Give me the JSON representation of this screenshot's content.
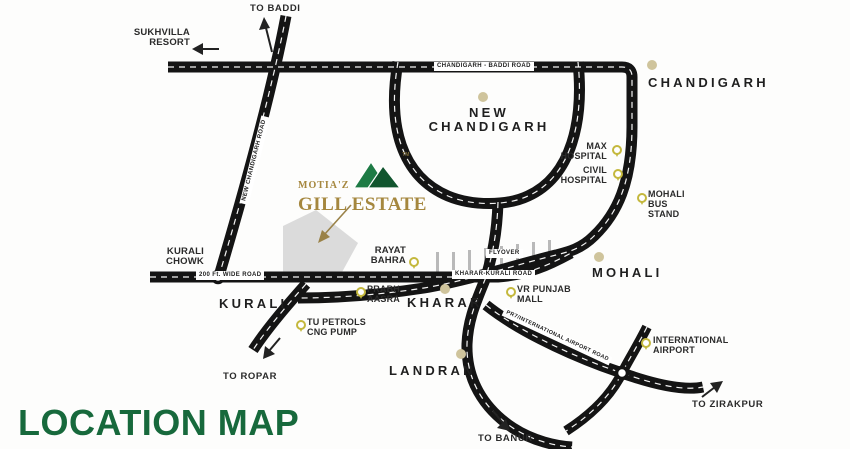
{
  "title": "LOCATION MAP",
  "logo": {
    "brand": "MOTIA'Z",
    "estate": "GILL ESTATE",
    "tm": "TM"
  },
  "cities": {
    "chandigarh": "CHANDIGARH",
    "new_chandigarh": "NEW CHANDIGARH",
    "mohali": "MOHALI",
    "kharar": "KHARAR",
    "kurali": "KURALI",
    "landran": "LANDRAN"
  },
  "places": {
    "sukhvilla_resort": "SUKHVILLA RESORT",
    "max_hospital": "MAX HOSPITAL",
    "civil_hospital": "CIVIL HOSPITAL",
    "mohali_bus_stand": "MOHALI BUS STAND",
    "kurali_chowk": "KURALI CHOWK",
    "rayat_bahra": "RAYAT BAHRA",
    "prabh_aasra": "PRABH AASRA",
    "tu_petrols_cng_pump": "TU PETROLS CNG PUMP",
    "vr_punjab_mall": "VR PUNJAB MALL",
    "international_airport": "INTERNATIONAL AIRPORT"
  },
  "directions": {
    "to_baddi": "TO BADDI",
    "to_ropar": "TO ROPAR",
    "to_banur": "TO BANUR",
    "to_zirakpur": "TO ZIRAKPUR"
  },
  "roads": {
    "chandigarh_baddi": "CHANDIGARH - BADDI ROAD",
    "new_chandigarh_road": "NEW CHANDIGARH ROAD",
    "wide_road": "200 Ft. WIDE ROAD",
    "kharar_kurali": "KHARAR-KURALI ROAD",
    "flyover": "FLYOVER",
    "pr7_airport_road": "PR7/INTERNATIONAL AIRPORT ROAD"
  },
  "colors": {
    "road": "#141414",
    "centerline": "#ffffff",
    "title_green": "#17693c",
    "logo_gold": "#a5873e",
    "logo_green_light": "#1e7b45",
    "logo_green_dark": "#11552e",
    "city_dot": "#cfc49c",
    "pin_yellow": "#c4b83d",
    "site_gray": "#dbdbdb"
  }
}
